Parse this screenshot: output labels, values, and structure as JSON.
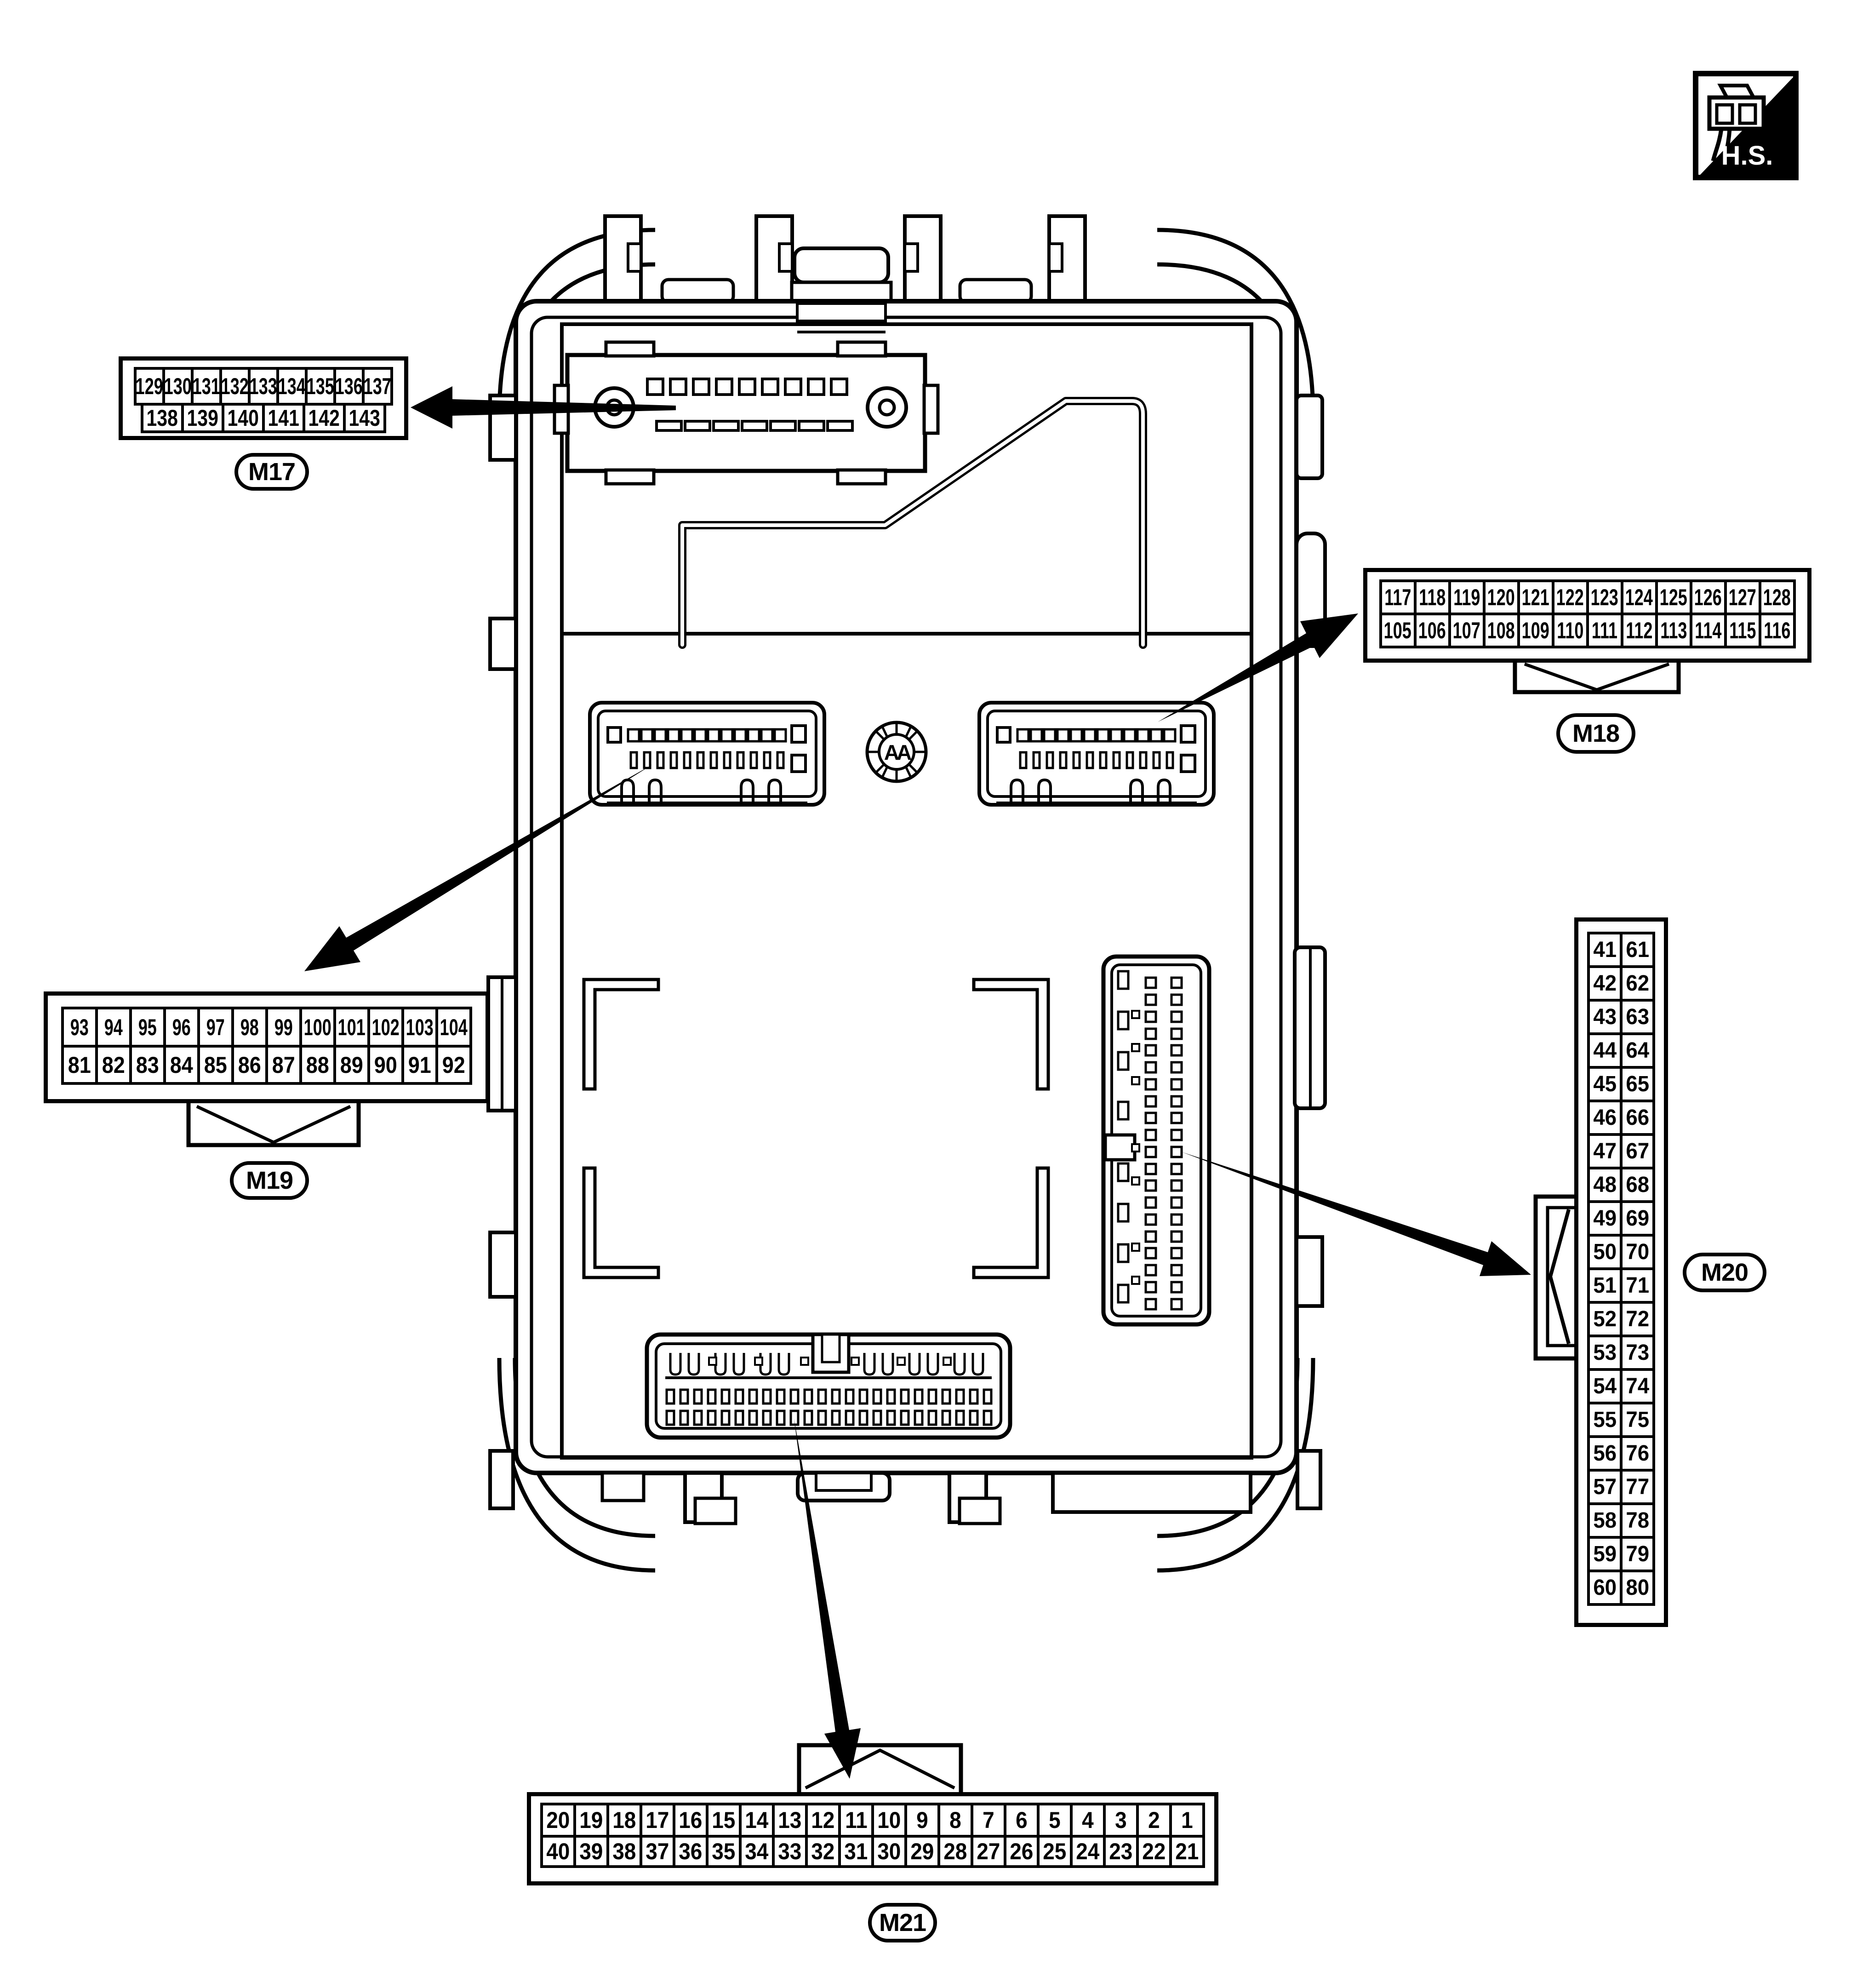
{
  "badge": {
    "label": "H.S."
  },
  "unit": {
    "marking": "AA"
  },
  "connectors": {
    "m17": {
      "label": "M17",
      "row1": [
        "129",
        "130",
        "131",
        "132",
        "133",
        "134",
        "135",
        "136",
        "137"
      ],
      "row2": [
        "138",
        "139",
        "140",
        "141",
        "142",
        "143"
      ]
    },
    "m18": {
      "label": "M18",
      "row1": [
        "117",
        "118",
        "119",
        "120",
        "121",
        "122",
        "123",
        "124",
        "125",
        "126",
        "127",
        "128"
      ],
      "row2": [
        "105",
        "106",
        "107",
        "108",
        "109",
        "110",
        "111",
        "112",
        "113",
        "114",
        "115",
        "116"
      ]
    },
    "m19": {
      "label": "M19",
      "row1": [
        "93",
        "94",
        "95",
        "96",
        "97",
        "98",
        "99",
        "100",
        "101",
        "102",
        "103",
        "104"
      ],
      "row2": [
        "81",
        "82",
        "83",
        "84",
        "85",
        "86",
        "87",
        "88",
        "89",
        "90",
        "91",
        "92"
      ]
    },
    "m20": {
      "label": "M20",
      "col1": [
        "41",
        "42",
        "43",
        "44",
        "45",
        "46",
        "47",
        "48",
        "49",
        "50",
        "51",
        "52",
        "53",
        "54",
        "55",
        "56",
        "57",
        "58",
        "59",
        "60"
      ],
      "col2": [
        "61",
        "62",
        "63",
        "64",
        "65",
        "66",
        "67",
        "68",
        "69",
        "70",
        "71",
        "72",
        "73",
        "74",
        "75",
        "76",
        "77",
        "78",
        "79",
        "80"
      ]
    },
    "m21": {
      "label": "M21",
      "row1": [
        "20",
        "19",
        "18",
        "17",
        "16",
        "15",
        "14",
        "13",
        "12",
        "11",
        "10",
        "9",
        "8",
        "7",
        "6",
        "5",
        "4",
        "3",
        "2",
        "1"
      ],
      "row2": [
        "40",
        "39",
        "38",
        "37",
        "36",
        "35",
        "34",
        "33",
        "32",
        "31",
        "30",
        "29",
        "28",
        "27",
        "26",
        "25",
        "24",
        "23",
        "22",
        "21"
      ]
    }
  }
}
